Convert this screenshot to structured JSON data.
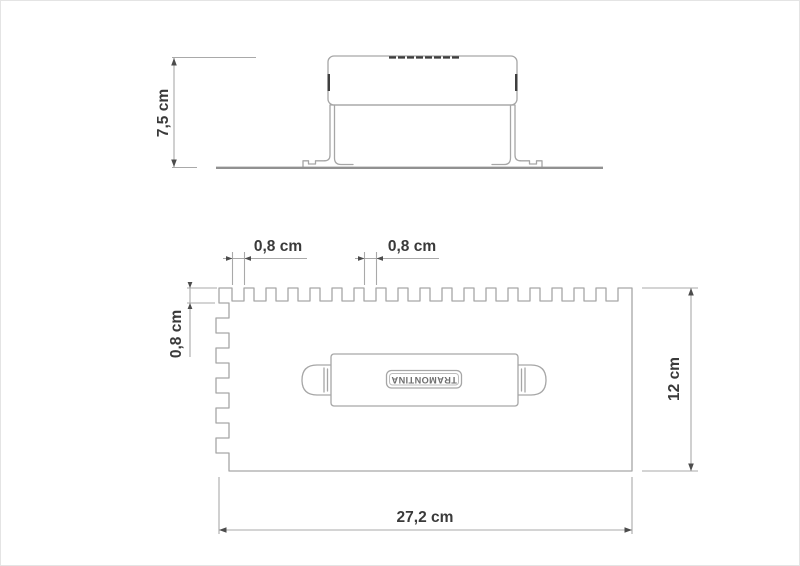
{
  "colors": {
    "background": "#ffffff",
    "outline": "#a6a6a6",
    "dimension_line": "#a9a9a9",
    "arrowhead": "#4c4c4c",
    "dimension_text": "#3a3a3a",
    "brand_text": "#6f6f6f"
  },
  "side_view": {
    "height_dim": "7,5 cm"
  },
  "plan_view": {
    "notch_width_dim_1": "0,8 cm",
    "notch_width_dim_2": "0,8 cm",
    "notch_depth_dim": "0,8 cm",
    "plate_depth_dim": "12 cm",
    "plate_width_dim": "27,2 cm",
    "brand": "TRAMONTINA"
  }
}
